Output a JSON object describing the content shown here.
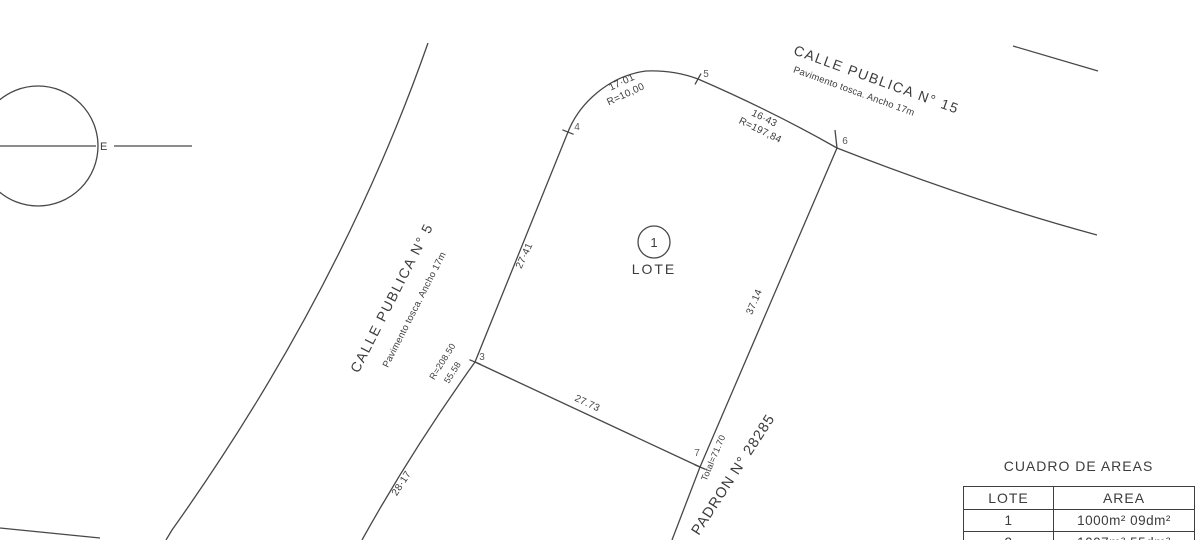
{
  "drawing": {
    "compass": {
      "east_label": "E"
    },
    "lot": {
      "number": "1",
      "label": "LOTE"
    },
    "streets": {
      "calle5": {
        "name": "CALLE PUBLICA N° 5",
        "detail": "Pavimento tosca. Ancho 17m"
      },
      "calle15": {
        "name": "CALLE PUBLICA N° 15",
        "detail": "Pavimento tosca. Ancho 17m"
      }
    },
    "padron_label": "PADRON N° 28285",
    "vertices": {
      "v3": "3",
      "v4": "4",
      "v5": "5",
      "v6": "6",
      "v7": "7"
    },
    "dims": {
      "front_nw_len": "17·01",
      "front_nw_radius": "R=10,00",
      "front_ne_len": "16·43",
      "front_ne_radius": "R=197,84",
      "west_len": "27·41",
      "west_radius": "R=208.50",
      "west_total": "55.58",
      "west_south_len": "28·17",
      "south_len": "27.73",
      "east_len": "37.14",
      "east_total": "Total=71.70"
    }
  },
  "areas_table": {
    "title": "CUADRO DE AREAS",
    "columns": [
      "LOTE",
      "AREA"
    ],
    "rows": [
      [
        "1",
        "1000m² 09dm²"
      ],
      [
        "2",
        "1007m² 55dm²"
      ]
    ]
  }
}
